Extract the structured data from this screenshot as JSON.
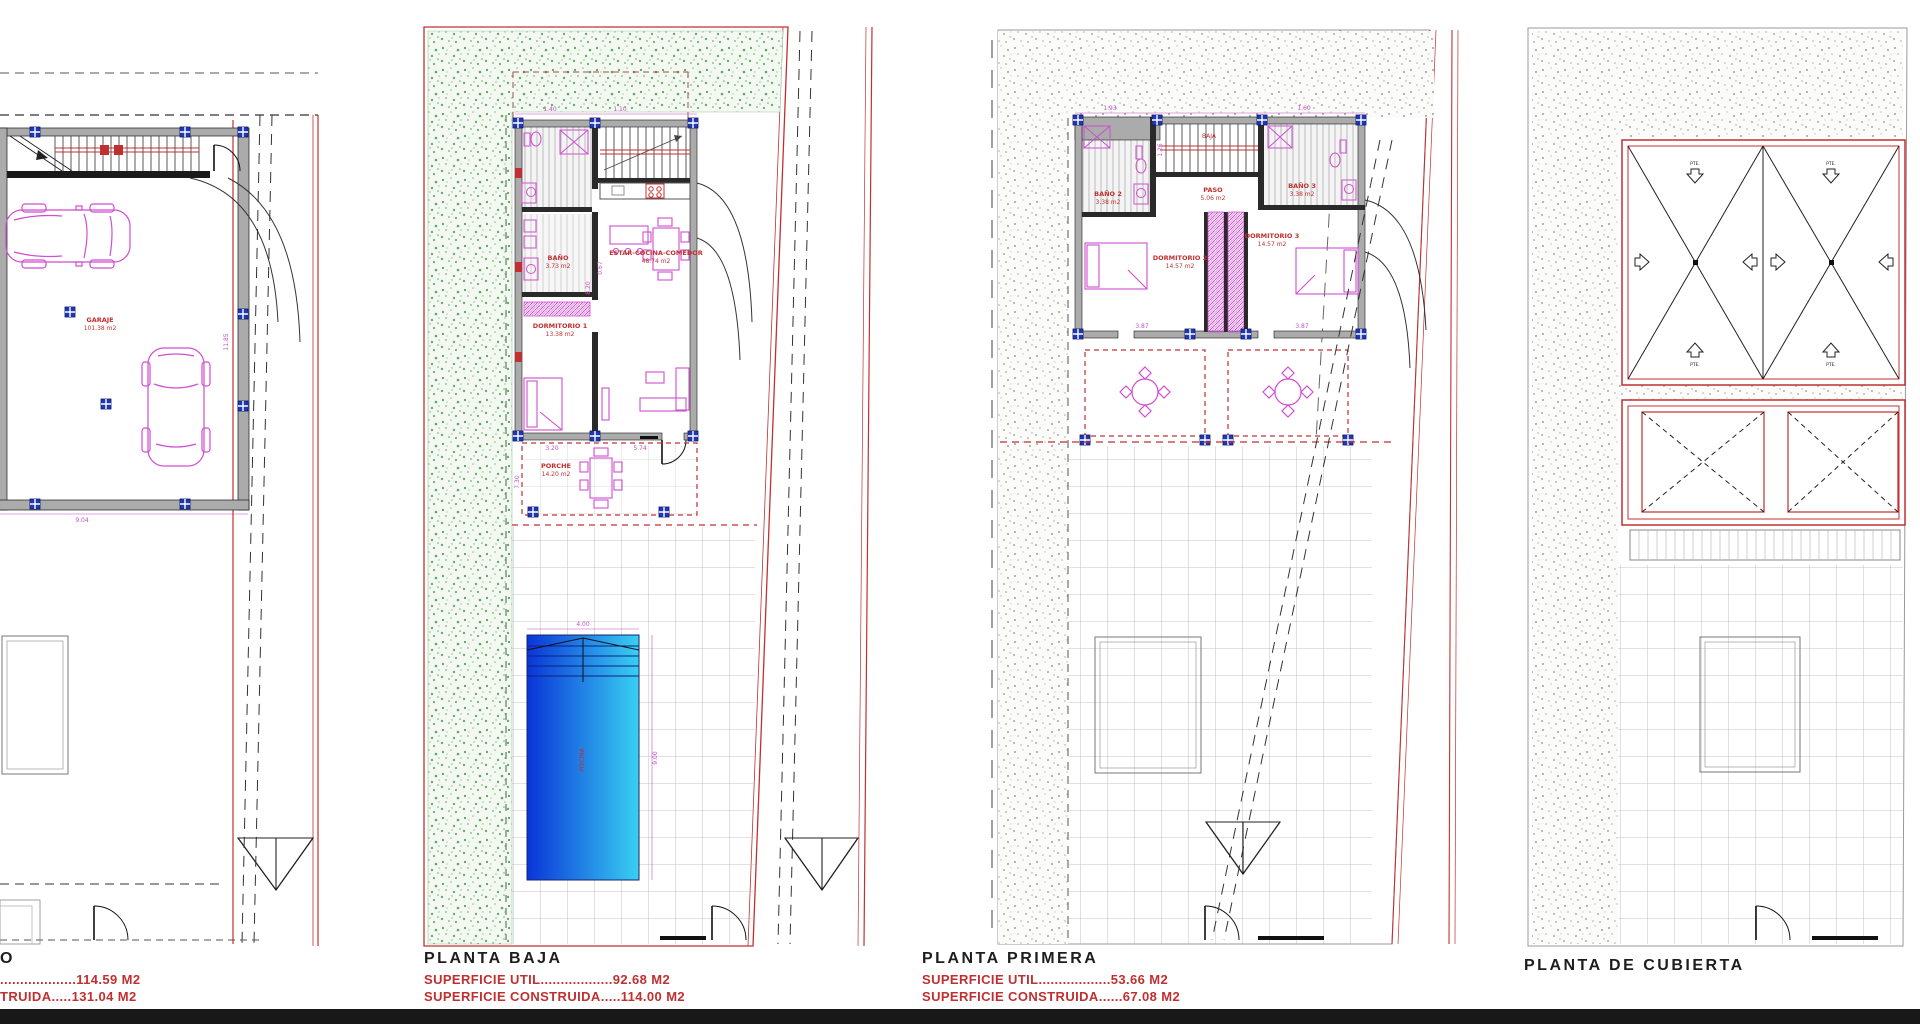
{
  "page": {
    "background": "#ffffff",
    "footer_color": "#181818",
    "accent_red": "#c03030",
    "accent_magenta": "#c44fc4",
    "green_dot": "#2e8b3a",
    "pool_gradient_from": "#0a34d8",
    "pool_gradient_to": "#39d0f2"
  },
  "plans": {
    "sotano": {
      "title": "O",
      "superficie_util": "...................114.59 M2",
      "superficie_construida": "TRUIDA.....131.04 M2",
      "garage_name": "GARAJE",
      "garage_area": "101.38 m2",
      "dim_width": "9.04",
      "dim_height": "11.85"
    },
    "baja": {
      "title": "PLANTA BAJA",
      "superficie_util": "SUPERFICIE UTIL..................92.68 M2",
      "superficie_construida": "SUPERFICIE CONSTRUIDA.....114.00 M2",
      "rooms": {
        "bano": {
          "name": "BAÑO",
          "area": "3.73 m2"
        },
        "dormitorio1": {
          "name": "DORMITORIO 1",
          "area": "13.38 m2"
        },
        "estar": {
          "name": "ESTAR-COCINA-COMEDOR",
          "area": "48.74 m2"
        },
        "porche": {
          "name": "PORCHE",
          "area": "14.20 m2"
        },
        "piscina": "PISCINA"
      },
      "dims": {
        "w1": "1.40",
        "w2": "1.10",
        "d1": "3.20",
        "d2": "5.74",
        "h1": "8.20",
        "h2": "0.67",
        "h3": "7.30",
        "pool_w": "4.00",
        "pool_h": "9.00"
      }
    },
    "primera": {
      "title": "PLANTA PRIMERA",
      "superficie_util": "SUPERFICIE UTIL..................53.66 M2",
      "superficie_construida": "SUPERFICIE CONSTRUIDA......67.08 M2",
      "rooms": {
        "bano2": {
          "name": "BAÑO 2",
          "area": "3.38 m2"
        },
        "bano3": {
          "name": "BAÑO 3",
          "area": "3.38 m2"
        },
        "paso": {
          "name": "PASO",
          "area": "5.06 m2"
        },
        "dormitorio2": {
          "name": "DORMITORIO 2",
          "area": "14.57 m2"
        },
        "dormitorio3": {
          "name": "DORMITORIO 3",
          "area": "14.57 m2"
        }
      },
      "stair_label": "BAJA",
      "dims": {
        "w1": "1.93",
        "w2": "1.60",
        "d1": "3.87",
        "d2": "3.87",
        "h1": "1.26"
      }
    },
    "cubierta": {
      "title": "PLANTA DE CUBIERTA",
      "arrow_label": "PTE."
    }
  }
}
